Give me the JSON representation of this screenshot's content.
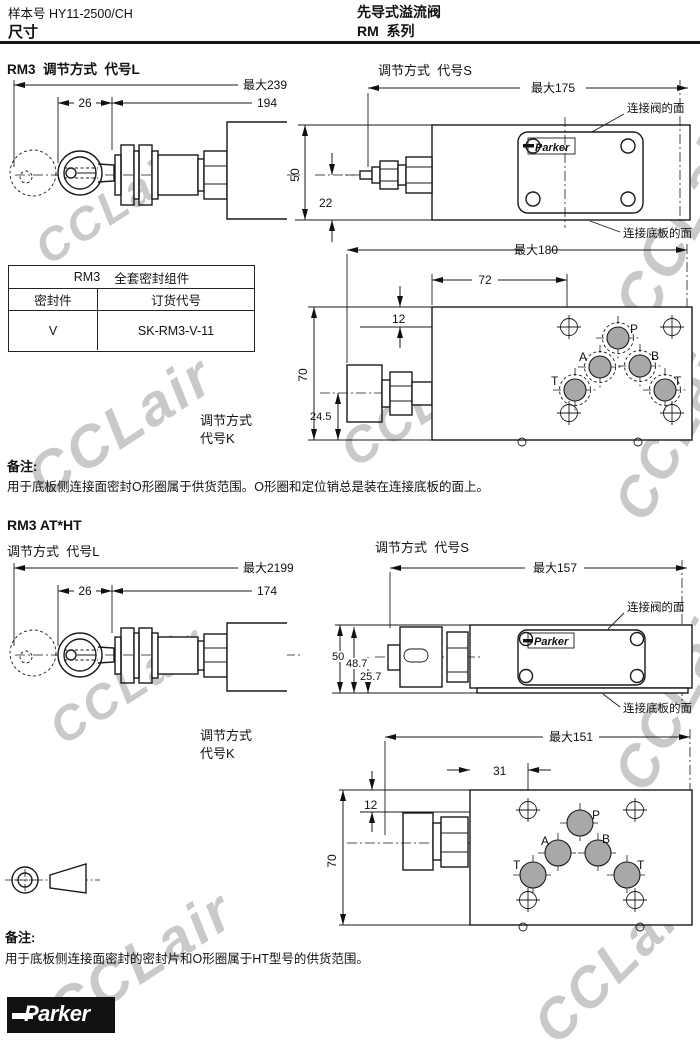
{
  "header": {
    "catalog_no": "样本号 HY11-2500/CH",
    "page_title": "尺寸",
    "product_title": "先导式溢流阀",
    "series_title": "RM  系列"
  },
  "watermark": {
    "text": "CCLair"
  },
  "section1": {
    "title": "RM3  调节方式  代号L",
    "adjust_s_title": "调节方式  代号S",
    "adjust_k": {
      "line1": "调节方式",
      "line2": "代号K"
    },
    "drawing_l": {
      "dim_max": "最大239",
      "dim_a": "26",
      "dim_b": "194"
    },
    "drawing_s": {
      "dim_max": "最大175",
      "dim_height": "50",
      "dim_center": "22",
      "label_valve_face": "连接阀的面",
      "label_plate_face": "连接底板的面",
      "plate_logo": "Parker"
    },
    "drawing_bottom": {
      "dim_max": "最大180",
      "dim_a": "72",
      "dim_b": "12",
      "dim_height": "70",
      "dim_center": "24.5",
      "ports": {
        "p": "P",
        "a": "A",
        "b": "B",
        "t1": "T",
        "t2": "T"
      }
    },
    "seal_table": {
      "header_model": "RM3",
      "header_title": "全套密封组件",
      "col_seal": "密封件",
      "col_order": "订货代号",
      "seal_value": "V",
      "order_value": "SK-RM3-V-11"
    },
    "note_label": "备注:",
    "note_text": "用于底板侧连接面密封O形圈属于供货范围。O形圈和定位销总是装在连接底板的面上。"
  },
  "section2": {
    "title": "RM3 AT*HT",
    "adjust_l_title": "调节方式  代号L",
    "adjust_s_title": "调节方式  代号S",
    "adjust_k": {
      "line1": "调节方式",
      "line2": "代号K"
    },
    "drawing_l": {
      "dim_max": "最大2199",
      "dim_a": "26",
      "dim_b": "174"
    },
    "drawing_s": {
      "dim_max": "最大157",
      "dim_h1": "50",
      "dim_h2": "48.7",
      "dim_center": "25.7",
      "label_valve_face": "连接阀的面",
      "label_plate_face": "连接底板的面",
      "plate_logo": "Parker"
    },
    "drawing_bottom": {
      "dim_max": "最大151",
      "dim_a": "31",
      "dim_b": "12",
      "dim_height": "70",
      "ports": {
        "p": "P",
        "a": "A",
        "b": "B",
        "t1": "T",
        "t2": "T"
      }
    },
    "note_label": "备注:",
    "note_text": "用于底板侧连接面密封的密封片和O形圈属于HT型号的供货范围。"
  },
  "footer": {
    "logo_text": "Parker"
  }
}
